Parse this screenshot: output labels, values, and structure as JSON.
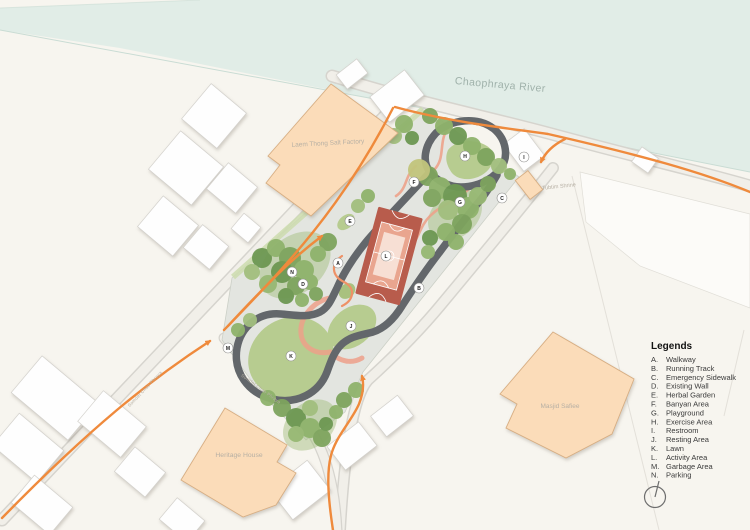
{
  "map": {
    "river_label": "Chaophraya River",
    "buildings": {
      "factory": "Laem Thong Salt Factory",
      "shrine": "Tubtim Shrine",
      "masjid": "Masjid Safiee",
      "heritage": "Heritage House"
    },
    "streets": {
      "street1": "Somdet Chao Phraya",
      "street2": "Somdet Chao Phraya"
    },
    "markers": [
      "A",
      "B",
      "C",
      "D",
      "E",
      "F",
      "G",
      "H",
      "I",
      "J",
      "K",
      "L",
      "M",
      "N"
    ]
  },
  "legend": {
    "title": "Legends",
    "items": [
      {
        "letter": "A.",
        "label": "Walkway"
      },
      {
        "letter": "B.",
        "label": "Running Track"
      },
      {
        "letter": "C.",
        "label": "Emergency Sidewalk"
      },
      {
        "letter": "D.",
        "label": "Existing Wall"
      },
      {
        "letter": "E.",
        "label": "Herbal Garden"
      },
      {
        "letter": "F.",
        "label": "Banyan Area"
      },
      {
        "letter": "G.",
        "label": "Playground"
      },
      {
        "letter": "H.",
        "label": "Exercise Area"
      },
      {
        "letter": "I.",
        "label": "Restroom"
      },
      {
        "letter": "J.",
        "label": "Resting Area"
      },
      {
        "letter": "K.",
        "label": "Lawn"
      },
      {
        "letter": "L.",
        "label": "Activity Area"
      },
      {
        "letter": "M.",
        "label": "Garbage Area"
      },
      {
        "letter": "N.",
        "label": "Parking"
      }
    ]
  },
  "icons": {
    "north": "north-arrow-icon"
  },
  "palette": {
    "accent_orange": "#ef8a3c",
    "building_peach": "#fbdcb9",
    "court_red": "#b85c4c",
    "lawn_green": "#b7cc90",
    "river_teal": "#e1ede7",
    "track_gray": "#63676b"
  }
}
